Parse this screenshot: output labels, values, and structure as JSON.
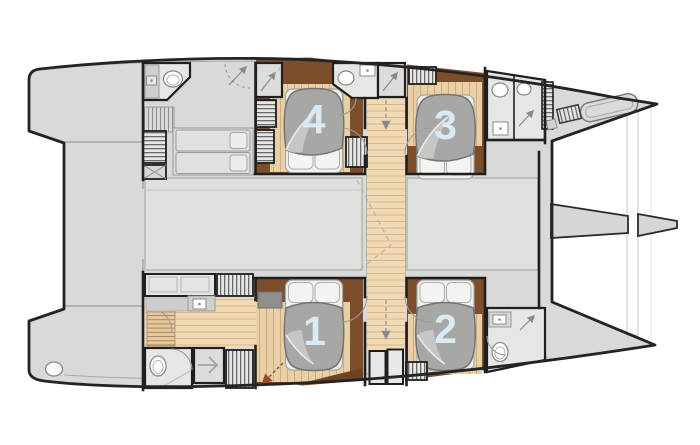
{
  "figure": {
    "kind": "catamaran-floor-plan"
  },
  "cabins": [
    {
      "id": "cabin-1",
      "label": "1"
    },
    {
      "id": "cabin-2",
      "label": "2"
    },
    {
      "id": "cabin-3",
      "label": "3"
    },
    {
      "id": "cabin-4",
      "label": "4"
    }
  ],
  "colors": {
    "deck_gray": "#d9d9d7",
    "hull_outline": "#242424",
    "cabin_floor_dark_wood": "#7d4e2b",
    "cabin_floor_light_wood": "#e8cfa6",
    "corridor_wood": "#f0d9b4",
    "duvet_gray": "#a7a7a5",
    "cabin_number_blue": "#d8eaf3",
    "saloon_panel": "#e0e0de",
    "bathroom_floor": "#e6e6e4",
    "escape_arrow_red": "#9c4a32"
  },
  "icons": {
    "toilet-icon": "white ellipse",
    "sink-icon": "square with dot",
    "shower-arrow-icon": "diagonal arrow",
    "stairs-icon": "hatched lines",
    "wardrobe-slats-icon": "striped box",
    "companionway-arrow-icon": "dashed arrow",
    "escape-route-arrow-icon": "red dashed arrow",
    "deck-hatch-icon": "rounded rectangle",
    "crossed-locker-icon": "box with X"
  }
}
